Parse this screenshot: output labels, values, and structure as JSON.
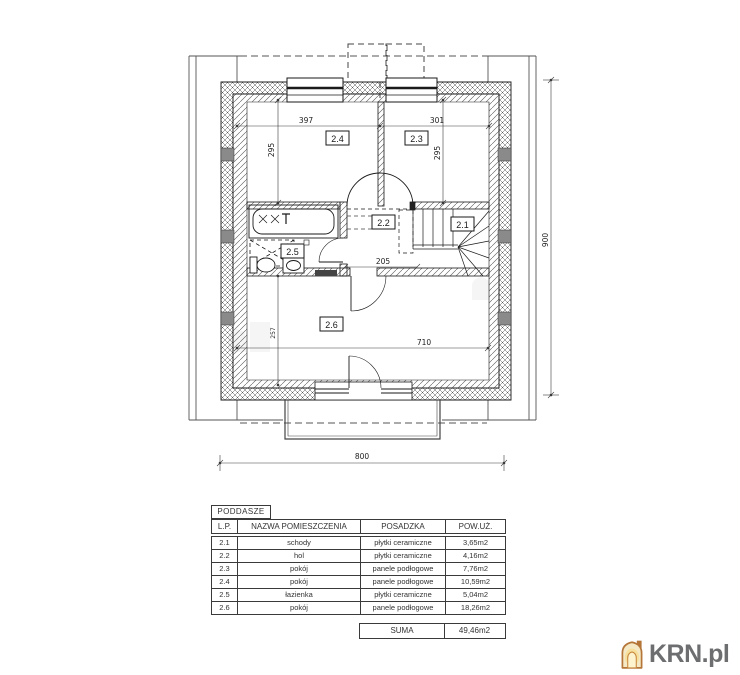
{
  "plan": {
    "rooms": {
      "r21": "2.1",
      "r22": "2.2",
      "r23": "2.3",
      "r24": "2.4",
      "r25": "2.5",
      "r26": "2.6"
    },
    "dims": {
      "top_left": "397",
      "top_right": "301",
      "side_left": "295",
      "side_right": "295",
      "hall": "205",
      "inner_width": "710",
      "room26_depth": "257",
      "total_width": "800",
      "total_height": "900"
    }
  },
  "legend_table": {
    "title": "PODDASZE",
    "columns": [
      "L.P.",
      "NAZWA POMIESZCZENIA",
      "POSADZKA",
      "POW.UŻ."
    ],
    "rows": [
      {
        "lp": "2.1",
        "name": "schody",
        "floor": "płytki ceramiczne",
        "area": "3,65m2"
      },
      {
        "lp": "2.2",
        "name": "hol",
        "floor": "płytki ceramiczne",
        "area": "4,16m2"
      },
      {
        "lp": "2.3",
        "name": "pokój",
        "floor": "panele podłogowe",
        "area": "7,76m2"
      },
      {
        "lp": "2.4",
        "name": "pokój",
        "floor": "panele podłogowe",
        "area": "10,59m2"
      },
      {
        "lp": "2.5",
        "name": "łazienka",
        "floor": "płytki ceramiczne",
        "area": "5,04m2"
      },
      {
        "lp": "2.6",
        "name": "pokój",
        "floor": "panele podłogowe",
        "area": "18,26m2"
      }
    ],
    "sum_label": "SUMA",
    "sum_value": "49,46m2"
  },
  "watermark": {
    "brand": "KRN.pl",
    "brand_color": "#6d6e70",
    "house_color": "#b5763a"
  }
}
